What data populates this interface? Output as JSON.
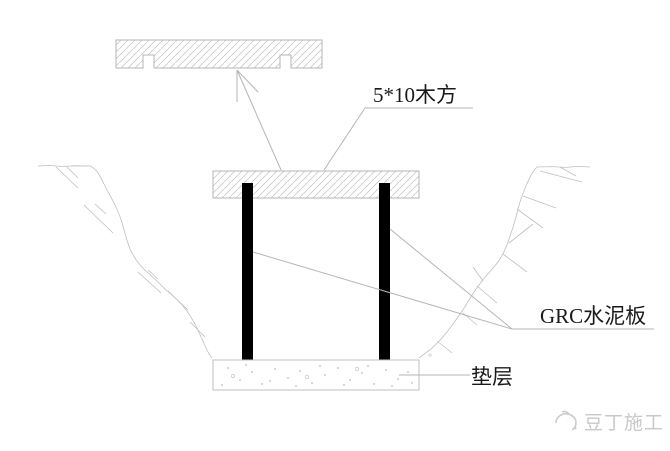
{
  "drawing": {
    "type": "construction-detail-section",
    "labels": {
      "wood_beam": {
        "text": "5*10木方"
      },
      "grc_board": {
        "text": "GRC水泥板"
      },
      "cushion": {
        "text": "垫层"
      }
    },
    "watermark": {
      "text": "豆丁施工"
    },
    "components": {
      "top_plate": "hatched-timber-plate-with-two-notches",
      "beam": "hatched-horizontal-beam",
      "posts": "two-solid-black-vertical-boards",
      "base": "stippled-cushion-layer",
      "ground": "excavation-slope-lines-left-and-right"
    },
    "colors": {
      "background": "#ffffff",
      "line": "#b5b5b5",
      "hatch": "#c9c9c9",
      "solid_bar": "#000000",
      "label_text": "#1a1a1a",
      "watermark": "#c9c9c9"
    }
  }
}
